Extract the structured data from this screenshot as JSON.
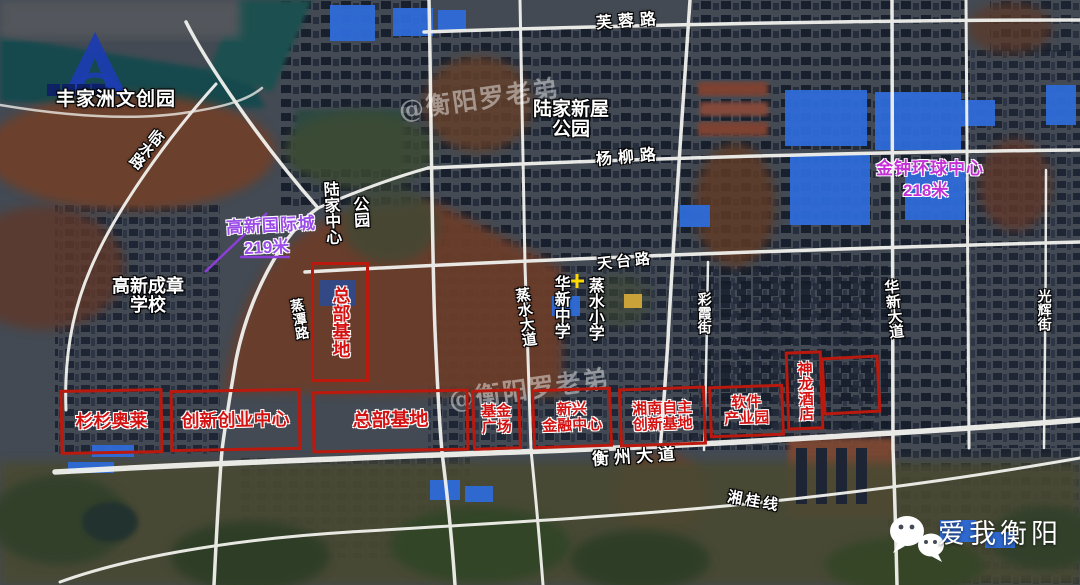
{
  "branding": {
    "logo": "A-logo",
    "wechat_account": "爱我衡阳",
    "watermark": "@衡阳罗老弟"
  },
  "roads": {
    "furong": "芙蓉路",
    "yangliu": "杨柳路",
    "tiantai": "天台路",
    "linshui": "临水路",
    "zhengtan": "蒸潭路",
    "zhengshui_avenue": "蒸水大道",
    "caixia": "彩霞街",
    "huaxin_avenue": "华新大道",
    "guanghui": "光辉街",
    "hengzhou_avenue": "衡州大道",
    "xianggui_line": "湘桂线"
  },
  "places": {
    "fengjiazhou": "丰家洲文创园",
    "lujia_xinwu_park": {
      "line1": "陆家新屋",
      "line2": "公园"
    },
    "lujia_center_park": {
      "col1": "陆家中心",
      "col2": "公园"
    },
    "gaoxin_chengzhang_school": {
      "line1": "高新成章",
      "line2": "学校"
    },
    "huaxin_middle_school": "华新中学",
    "zhengshui_primary_school": "蒸水小学"
  },
  "towers": {
    "gaoxin_international_city": {
      "name": "高新国际城",
      "height": "219米"
    },
    "jinzhong_global_center": {
      "name": "金钟环球中心",
      "height": "218米"
    }
  },
  "zones": {
    "hq_base_vertical": "总部基地",
    "shanshan_outlets": "杉杉奥莱",
    "innovation_center": "创新创业中心",
    "hq_base": "总部基地",
    "fund_plaza": {
      "line1": "基金",
      "line2": "广场"
    },
    "emerging_finance": {
      "line1": "新兴",
      "line2": "金融中心"
    },
    "xiangnan_innovation": {
      "line1": "湘南自主",
      "line2": "创新基地"
    },
    "software_park": {
      "line1": "软件",
      "line2": "产业园"
    },
    "shenlong_hotel": "神龙酒店"
  },
  "colors": {
    "red_box": "#bb190d",
    "red_text": "#d41212",
    "purple_text": "#9b4ce8",
    "magenta_text": "#c42fd6",
    "marker_yellow": "#ffd900",
    "logo_blue": "#1c3cb0",
    "road_white": "#f2f2ee"
  }
}
